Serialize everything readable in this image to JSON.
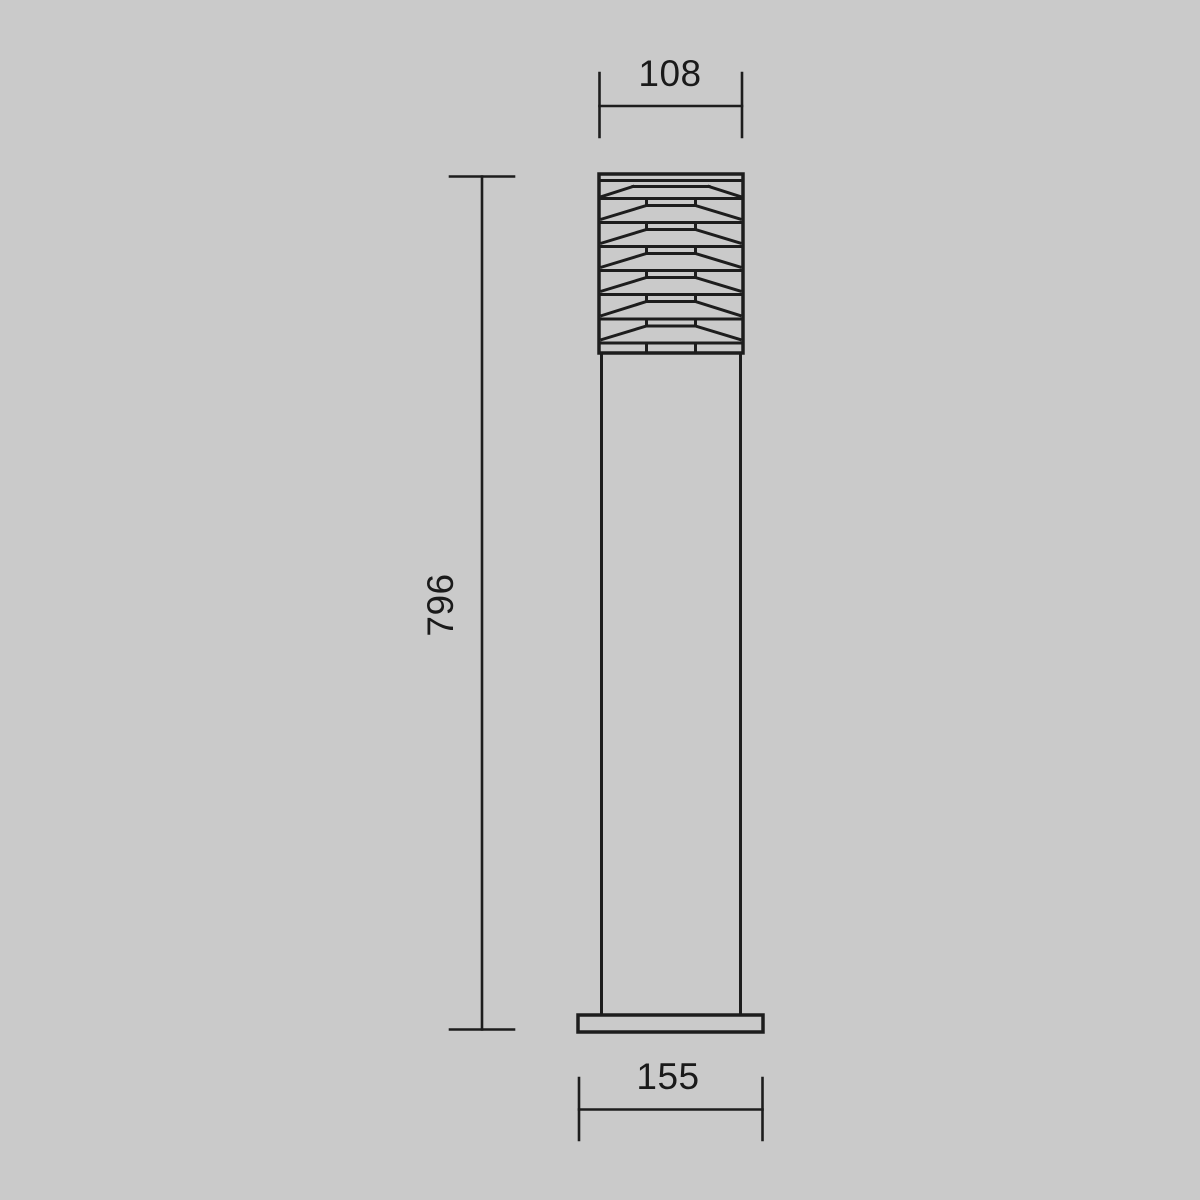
{
  "drawing": {
    "type": "technical-dimension-drawing",
    "subject": "outdoor bollard light with louvered head, front elevation",
    "dimensions": {
      "head_width": "108",
      "overall_height": "796",
      "base_width": "155"
    },
    "colors": {
      "background": "#cacaca",
      "line": "#1d1d1d",
      "text": "#1a1a1a"
    }
  }
}
